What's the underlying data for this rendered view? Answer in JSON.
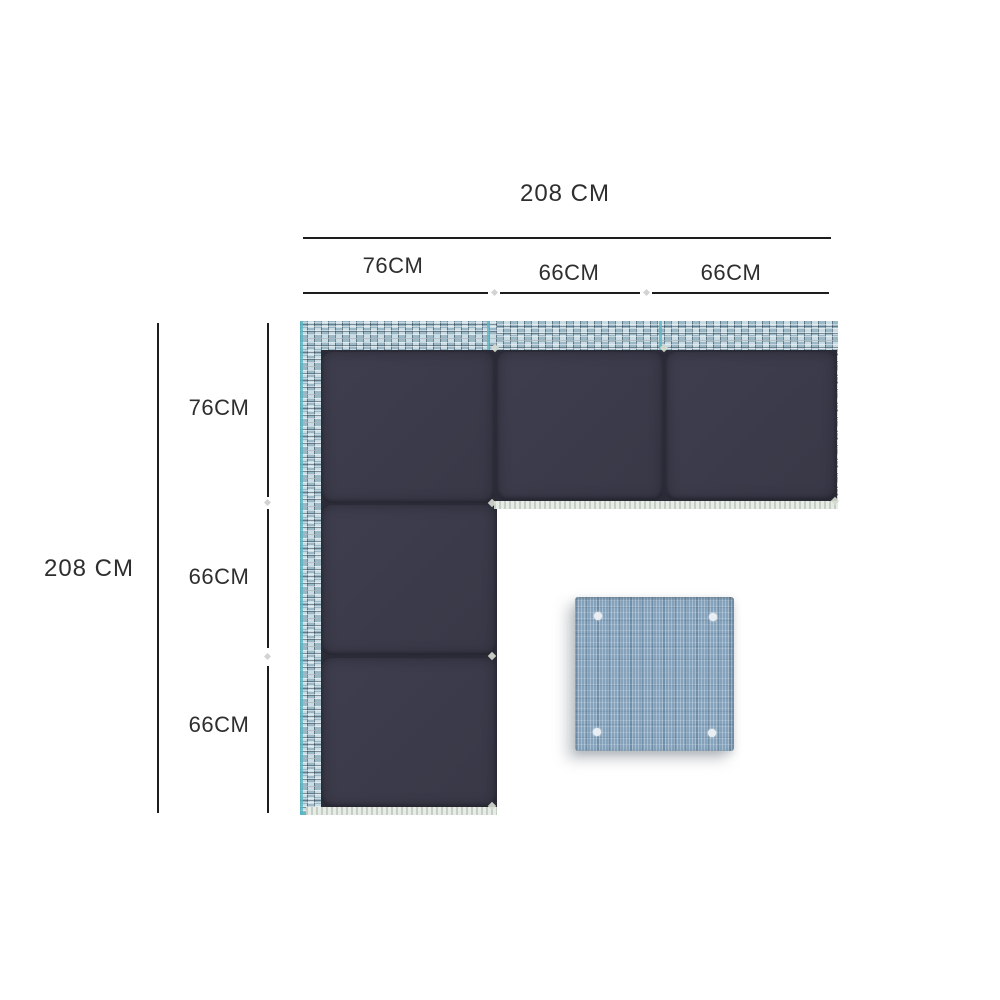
{
  "diagram": {
    "kind": "corner-sofa-dimension-top-view",
    "top_dimension": {
      "total": "208 CM",
      "segments": [
        "76CM",
        "66CM",
        "66CM"
      ]
    },
    "left_dimension": {
      "total": "208 CM",
      "segments": [
        "76CM",
        "66CM",
        "66CM"
      ]
    },
    "sofa": {
      "cushion_count": 5,
      "shape": "L"
    },
    "side_table": {
      "button_count": 4
    }
  },
  "colors": {
    "background": "#ffffff",
    "dimension-line": "#1d1d1d",
    "dimension-text": "#2e2e2e",
    "cushion": "#3b3b4b",
    "cushion-dark": "#2b2b37",
    "wicker-base": "#aec6d2",
    "wicker-light": "#c9dbe3",
    "wicker-mid": "#9bb8c6",
    "teal-accent": "#57b6c6",
    "edge-strip-light": "#e8ece6",
    "edge-strip-dark": "#c6cfc6",
    "table-blue": "#84a2bb",
    "table-dot": "#e9eef2"
  }
}
